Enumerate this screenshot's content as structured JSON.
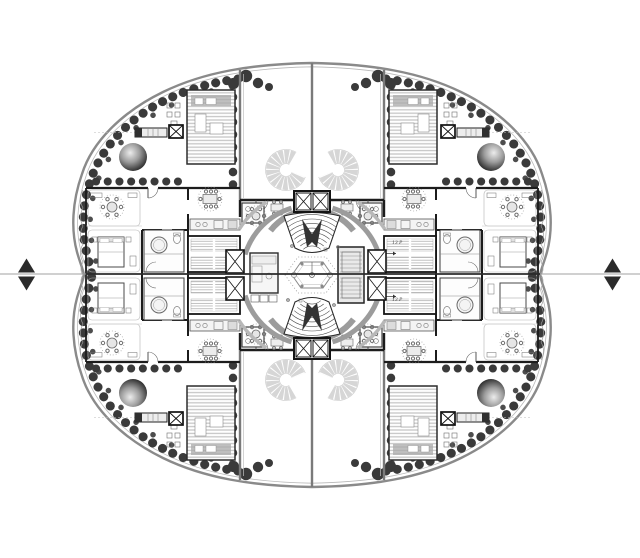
{
  "drawing": {
    "annotations": [
      {
        "text": "13 P"
      },
      {
        "text": "13 P"
      }
    ],
    "icons": {
      "section_marker": "double filled triangle",
      "tree_canopy": "shaded sphere",
      "elevator_shaft": "box with X",
      "stair_treads": "hatched band"
    },
    "colors": {
      "paper": "#ffffff",
      "ink": "#1c1c1c",
      "wall_gray": "#7a7a7a",
      "band_gray": "#9c9c9c",
      "tree": "#3a3a3a",
      "spiral_gray": "#d6d6d6",
      "deck_stripe": "#c6c6c6"
    }
  }
}
